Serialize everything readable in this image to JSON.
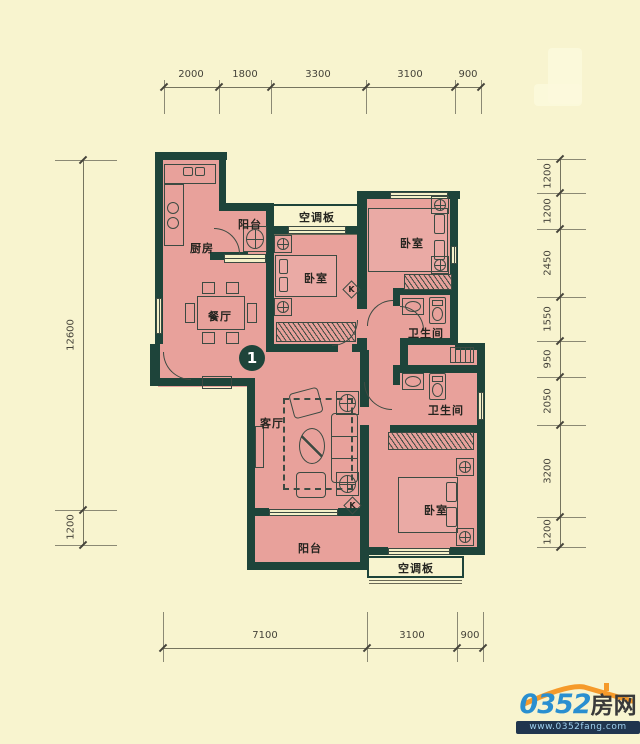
{
  "colors": {
    "background": "#f8f4cf",
    "room_fill": "#e8a19b",
    "wall": "#1e443a",
    "line": "#3c4a42",
    "dim_text": "#45433a",
    "logo_orange": "#f59a2b",
    "logo_blue": "#2a8fd0",
    "logo_dark": "#3a3a3a",
    "strip_bg": "#20354e",
    "strip_text": "#9fd0ee"
  },
  "dims": {
    "top": [
      "2000",
      "1800",
      "3300",
      "3100",
      "900"
    ],
    "bottom": [
      "7100",
      "3100",
      "900"
    ],
    "left": [
      "12600",
      "1200"
    ],
    "right": [
      "1200",
      "1200",
      "2450",
      "1550",
      "950",
      "2050",
      "3200",
      "1200"
    ]
  },
  "rooms": {
    "kitchen": "厨房",
    "balcony_top": "阳台",
    "ac_top": "空调板",
    "bedroom_mid": "卧室",
    "bedroom_top_right": "卧室",
    "bath_top": "卫生间",
    "dining": "餐厅",
    "living": "客厅",
    "bath_bottom": "卫生间",
    "bedroom_bottom_right": "卧室",
    "balcony_bottom": "阳台",
    "ac_bottom": "空调板"
  },
  "badge": {
    "unit": "1"
  },
  "marks": {
    "door": "K"
  },
  "logo": {
    "number": "0352",
    "suffix": "房网",
    "website": "www.0352fang.com"
  }
}
